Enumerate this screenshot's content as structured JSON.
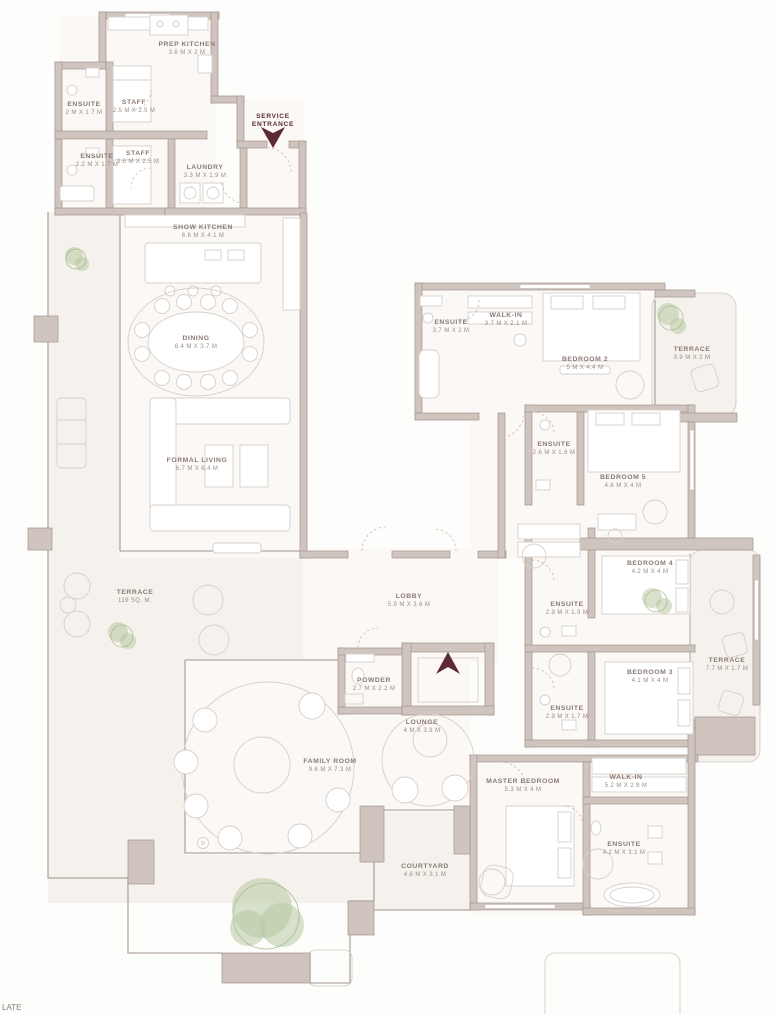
{
  "colors": {
    "accent": "#5d2a31",
    "wall": "#cfc5be",
    "wall_stroke": "#a2958d",
    "floor": "#fbf8f5",
    "terrace": "#f5f1ec",
    "label_text": "#8a7b74",
    "plant": "#b7c9a1"
  },
  "entrances": {
    "service": {
      "line1": "SERVICE",
      "line2": "ENTRANCE"
    }
  },
  "corner_partial_text": "LATE",
  "rooms": [
    {
      "name": "PREP KITCHEN",
      "dims": "3.6 M X 2 M"
    },
    {
      "name": "ENSUITE",
      "dims": "2 M X 1.7 M"
    },
    {
      "name": "STAFF",
      "dims": "2.5 M X 2.5 M"
    },
    {
      "name": "ENSUITE",
      "dims": "2.2 M X 1.7 M"
    },
    {
      "name": "STAFF",
      "dims": "3.6 M X 2.5 M"
    },
    {
      "name": "LAUNDRY",
      "dims": "3.3 M X 1.9 M"
    },
    {
      "name": "SHOW KITCHEN",
      "dims": "6.6 M X 4.1 M"
    },
    {
      "name": "DINING",
      "dims": "6.4 M X 3.7 M"
    },
    {
      "name": "FORMAL LIVING",
      "dims": "6.7 M X 6.4 M"
    },
    {
      "name": "TERRACE",
      "dims": "119 SQ. M."
    },
    {
      "name": "ENSUITE",
      "dims": "3.7 M X 2 M"
    },
    {
      "name": "WALK-IN",
      "dims": "3.7 M X 2.1 M"
    },
    {
      "name": "BEDROOM 2",
      "dims": "5 M X 4.4 M"
    },
    {
      "name": "TERRACE",
      "dims": "3.9 M X 2 M"
    },
    {
      "name": "ENSUITE",
      "dims": "2.6 M X 1.6 M"
    },
    {
      "name": "BEDROOM 5",
      "dims": "4.6 M X 4 M"
    },
    {
      "name": "BEDROOM 4",
      "dims": "4.2 M X 4 M"
    },
    {
      "name": "ENSUITE",
      "dims": "2.9 M X 1.9 M"
    },
    {
      "name": "BEDROOM 3",
      "dims": "4.1 M X 4 M"
    },
    {
      "name": "ENSUITE",
      "dims": "2.9 M X 1.7 M"
    },
    {
      "name": "TERRACE",
      "dims": "7.7 M X 1.7 M"
    },
    {
      "name": "LOBBY",
      "dims": "5.9 M X 3.6 M"
    },
    {
      "name": "POWDER",
      "dims": "2.7 M X 2.2 M"
    },
    {
      "name": "LOUNGE",
      "dims": "4 M X 3.9 M"
    },
    {
      "name": "FAMILY ROOM",
      "dims": "9.6 M X 7.3 M"
    },
    {
      "name": "MASTER BEDROOM",
      "dims": "5.3 M X 4 M"
    },
    {
      "name": "WALK-IN",
      "dims": "5.2 M X 2.8 M"
    },
    {
      "name": "ENSUITE",
      "dims": "4.2 M X 3.1 M"
    },
    {
      "name": "COURTYARD",
      "dims": "4.6 M X 3.1 M"
    }
  ]
}
